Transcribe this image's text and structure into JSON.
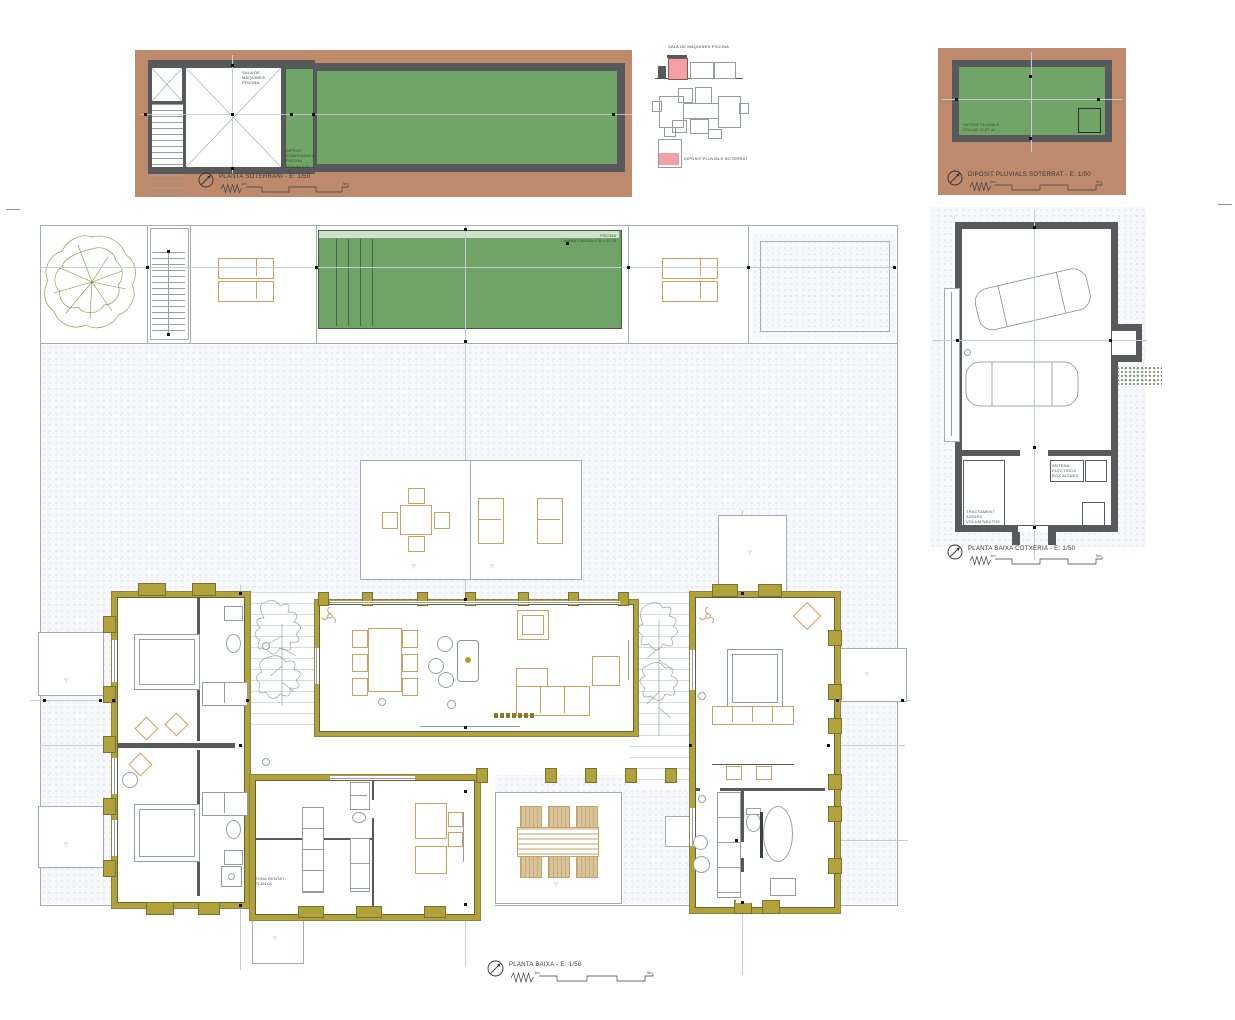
{
  "colors": {
    "paper": "#ffffff",
    "earth_brown": "#bd8a6c",
    "wall_dark": "#58595b",
    "pool_green": "#71a567",
    "pool_light_band": "#d2e3cd",
    "wall_ochre": "#b2a23c",
    "furniture_tan": "#c9a163",
    "ground_stipple": "#c3cdde",
    "highlight_pink": "#f2a0a5",
    "centerline": "#c6ccd5"
  },
  "basement": {
    "title": "PLANTA SOTERRANI - E: 1/50",
    "machine_room_label": "SALA DE MÀQUINES PISCINA",
    "tank_l1": "DIPÒSIT",
    "tank_l2": "COMPENSACIÓ PISCINA",
    "tank_l3": "VOLUM 4,50 m³"
  },
  "key": {
    "machine_title": "SALA DE MÀQUINES PISCINA",
    "rain_title": "DIPÒSIT PLUVIALS SOTERRAT"
  },
  "rain": {
    "title": "DIPÒSIT PLUVIALS SOTERRAT - E: 1/50",
    "l1": "DIPÒSIT PLUVIALS",
    "l2": "VOLUM: 37,87 m³"
  },
  "garage": {
    "title": "PLANTA BAIXA COTXERIA - E: 1/50",
    "ant_l1": "ANTENA ELÈCTRICA",
    "ant_l2": "BOX AIGÜES",
    "tr_l1": "TRACTAMENT AIGÜES",
    "tr_l2": "VOLUM NEUTRE"
  },
  "ground": {
    "title": "PLANTA BAIXA - E: 1/50",
    "pool_l1": "PISCINA",
    "pool_l2": "LÀMINA D'AIGUA 4,35 x 20,35",
    "laundry": "ZONA RENTAT-PLANXA"
  },
  "scale": {
    "one": "1m",
    "five": "5m"
  }
}
